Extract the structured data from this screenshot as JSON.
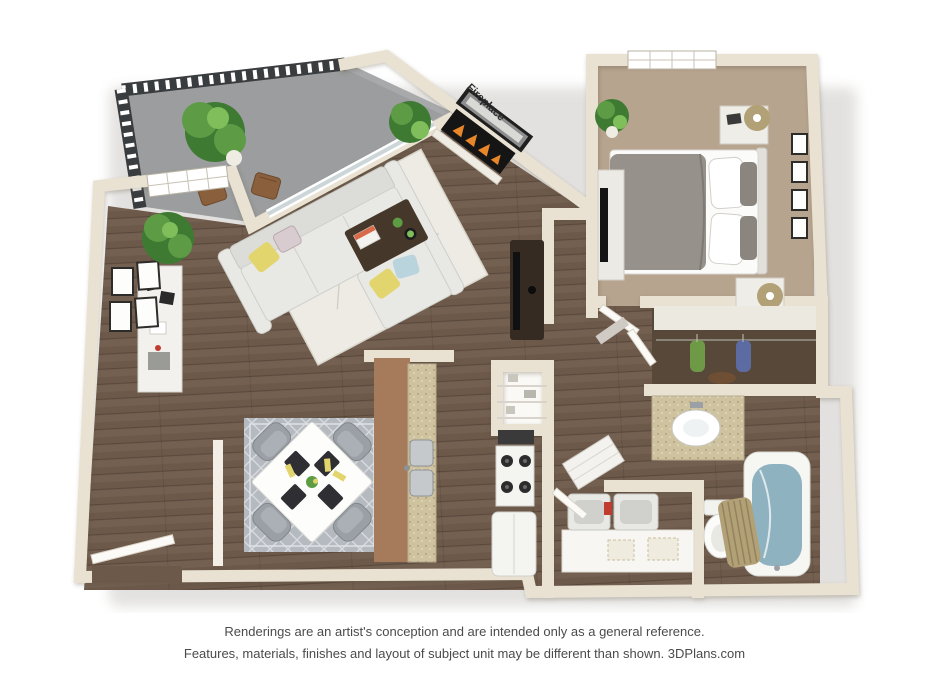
{
  "caption": {
    "line1": "Renderings are an artist's conception and are intended only as a general reference.",
    "line2": "Features, materials, finishes and layout of subject unit may be different than shown. 3DPlans.com"
  },
  "labels": {
    "fireplace": "Fireplace"
  },
  "palette": {
    "wall_face": "#e9e2d3",
    "wall_edge": "#cfc6b3",
    "wood": "#6d594a",
    "carpet": "#b7a48e",
    "balcony": "#a7a9ab",
    "railing": "#3a3d40",
    "rug_living": "#edebe3",
    "rug_dining": "#b5bac0",
    "sofa": "#e8e8e5",
    "table_dark": "#453729",
    "tv_dark": "#352b22",
    "duvet": "#96918b",
    "cabinet": "#a67b5b",
    "granite": "#cfc29f",
    "water": "#8fb2c1",
    "curtain": "#b2a177",
    "appliance": "#f4f4f1",
    "closet_floor": "#584839",
    "pillow_yellow": "#e3d56e",
    "pillow_blue": "#bad4dd",
    "clothes_green": "#6e9a48",
    "clothes_blue": "#5c6ba1",
    "door_white": "#fbfaf7",
    "plant_dark": "#3f7a33",
    "plant_mid": "#5d9c44",
    "plant_light": "#7fbe5a",
    "text": "#4b4b4b"
  }
}
